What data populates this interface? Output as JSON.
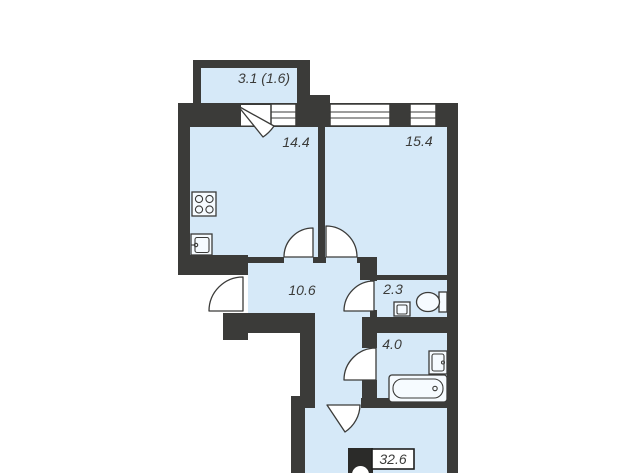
{
  "rooms": {
    "balcony": {
      "label": "3.1 (1.6)"
    },
    "kitchen": {
      "label": "14.4"
    },
    "bedroom": {
      "label": "15.4"
    },
    "hallway": {
      "label": "10.6"
    },
    "toilet": {
      "label": "2.3"
    },
    "bathroom": {
      "label": "4.0"
    }
  },
  "badge": {
    "total_area": "32.6"
  },
  "colors": {
    "wall": "#3b3b39",
    "room_fill": "#d6e9f8",
    "background": "#ffffff",
    "outline": "#3b3b39",
    "badge_black": "#2b2b29"
  },
  "icons": [
    "stove-icon",
    "kitchen-sink-icon",
    "wc-toilet-icon",
    "toilet-sink-icon",
    "washbasin-icon",
    "bathtub-icon",
    "logo-circle-icon"
  ]
}
